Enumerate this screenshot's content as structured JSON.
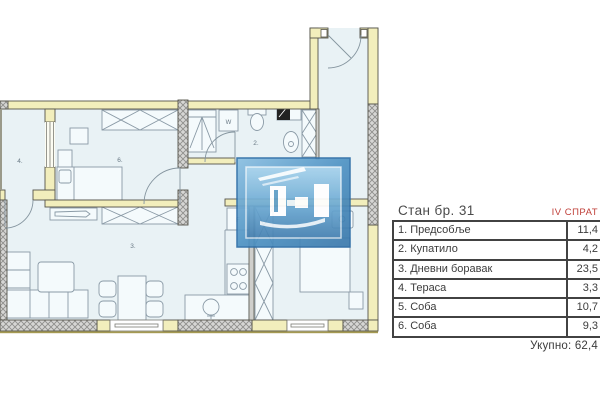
{
  "floor_plan": {
    "room_labels": {
      "room4": "4.",
      "room6": "6.",
      "room3": "3.",
      "room2": "2."
    },
    "appliances": {
      "washer": "W",
      "fridge": "F"
    }
  },
  "info_panel": {
    "title": "Стан бр. 31",
    "floor": "IV СПРАТ",
    "rows": [
      {
        "label": "1. Предсобље",
        "value": "11,4"
      },
      {
        "label": "2. Купатило",
        "value": "4,2"
      },
      {
        "label": "3. Дневни боравак",
        "value": "23,5"
      },
      {
        "label": "4. Тераса",
        "value": "3,3"
      },
      {
        "label": "5. Соба",
        "value": "10,7"
      },
      {
        "label": "6. Соба",
        "value": "9,3"
      }
    ],
    "total_label": "Укупно:",
    "total_value": "62,4"
  },
  "colors": {
    "wall_yellow": "#f2eebc",
    "floor_blue": "#e9f2f5",
    "accent_red": "#c0403a",
    "logo_blue": "#4a8fc0",
    "text_dark": "#3c3c3c"
  }
}
